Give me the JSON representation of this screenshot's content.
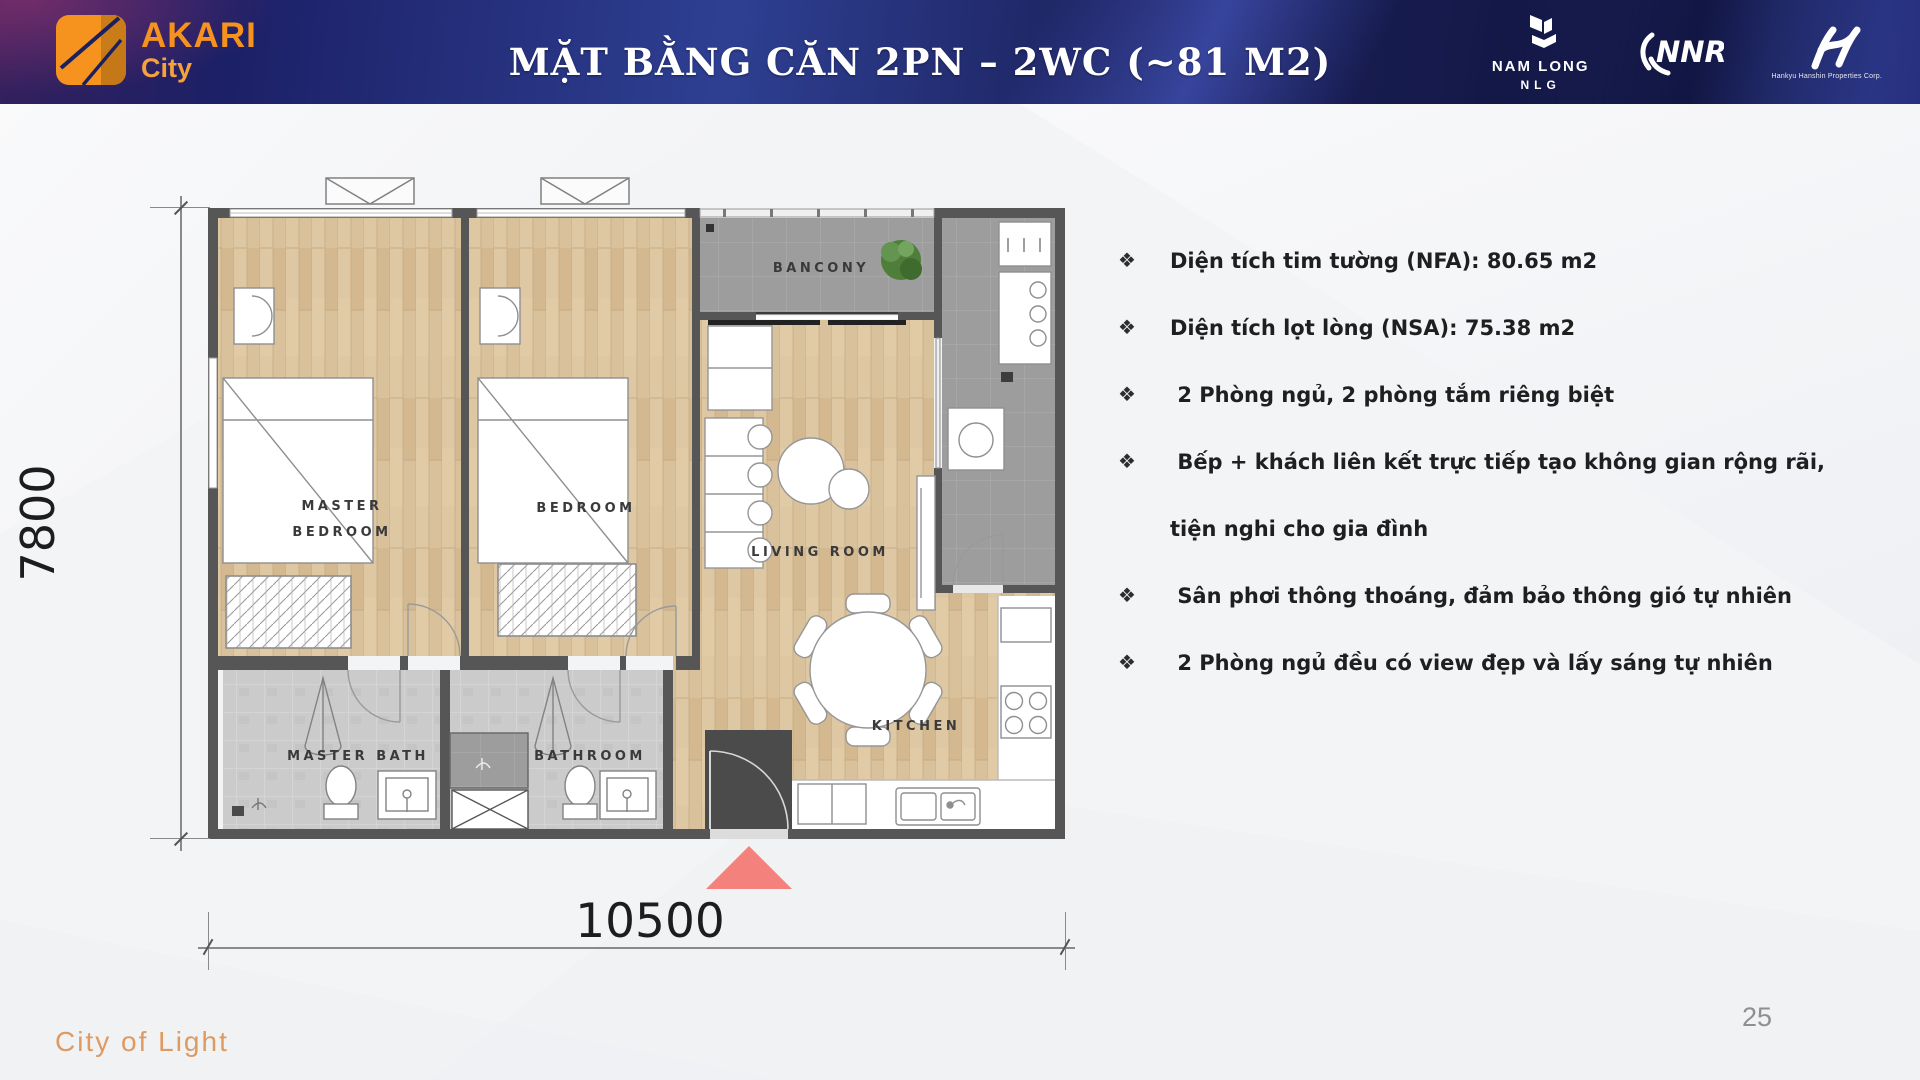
{
  "header": {
    "logo": {
      "brand": "AKARI",
      "sub": "City"
    },
    "title": "MẶT BẰNG CĂN 2PN – 2WC (~81 M2)",
    "partners": {
      "nam_long": "NAM LONG",
      "nlg": "NLG",
      "nnr": "NNR",
      "hankyu_caption": "Hankyu Hanshin Properties Corp."
    }
  },
  "floor_plan": {
    "labels": {
      "balcony": "BANCONY",
      "master_bedroom_1": "MASTER",
      "master_bedroom_2": "BEDROOM",
      "bedroom": "BEDROOM",
      "living_room": "LIVING ROOM",
      "kitchen": "KITCHEN",
      "master_bath": "MASTER BATH",
      "bathroom": "BATHROOM"
    },
    "dimensions": {
      "width": "10500",
      "height": "7800"
    }
  },
  "features": {
    "marker": "❖",
    "items": [
      "Diện tích tim tường (NFA): 80.65 m2",
      "Diện tích lọt lòng (NSA): 75.38 m2",
      " 2 Phòng ngủ, 2 phòng tắm riêng biệt",
      " Bếp + khách liên kết trực tiếp tạo không gian rộng rãi, tiện nghi cho gia đình",
      " Sân phơi thông thoáng, đảm bảo thông gió tự nhiên",
      " 2 Phòng ngủ đều có view đẹp và lấy sáng tự nhiên"
    ]
  },
  "footer": {
    "tagline": "City of Light",
    "page": "25"
  },
  "colors": {
    "accent_orange": "#F6921E",
    "header_navy": "#1B2060",
    "entrance_arrow": "#F5817D",
    "wall_gray": "#565656"
  }
}
